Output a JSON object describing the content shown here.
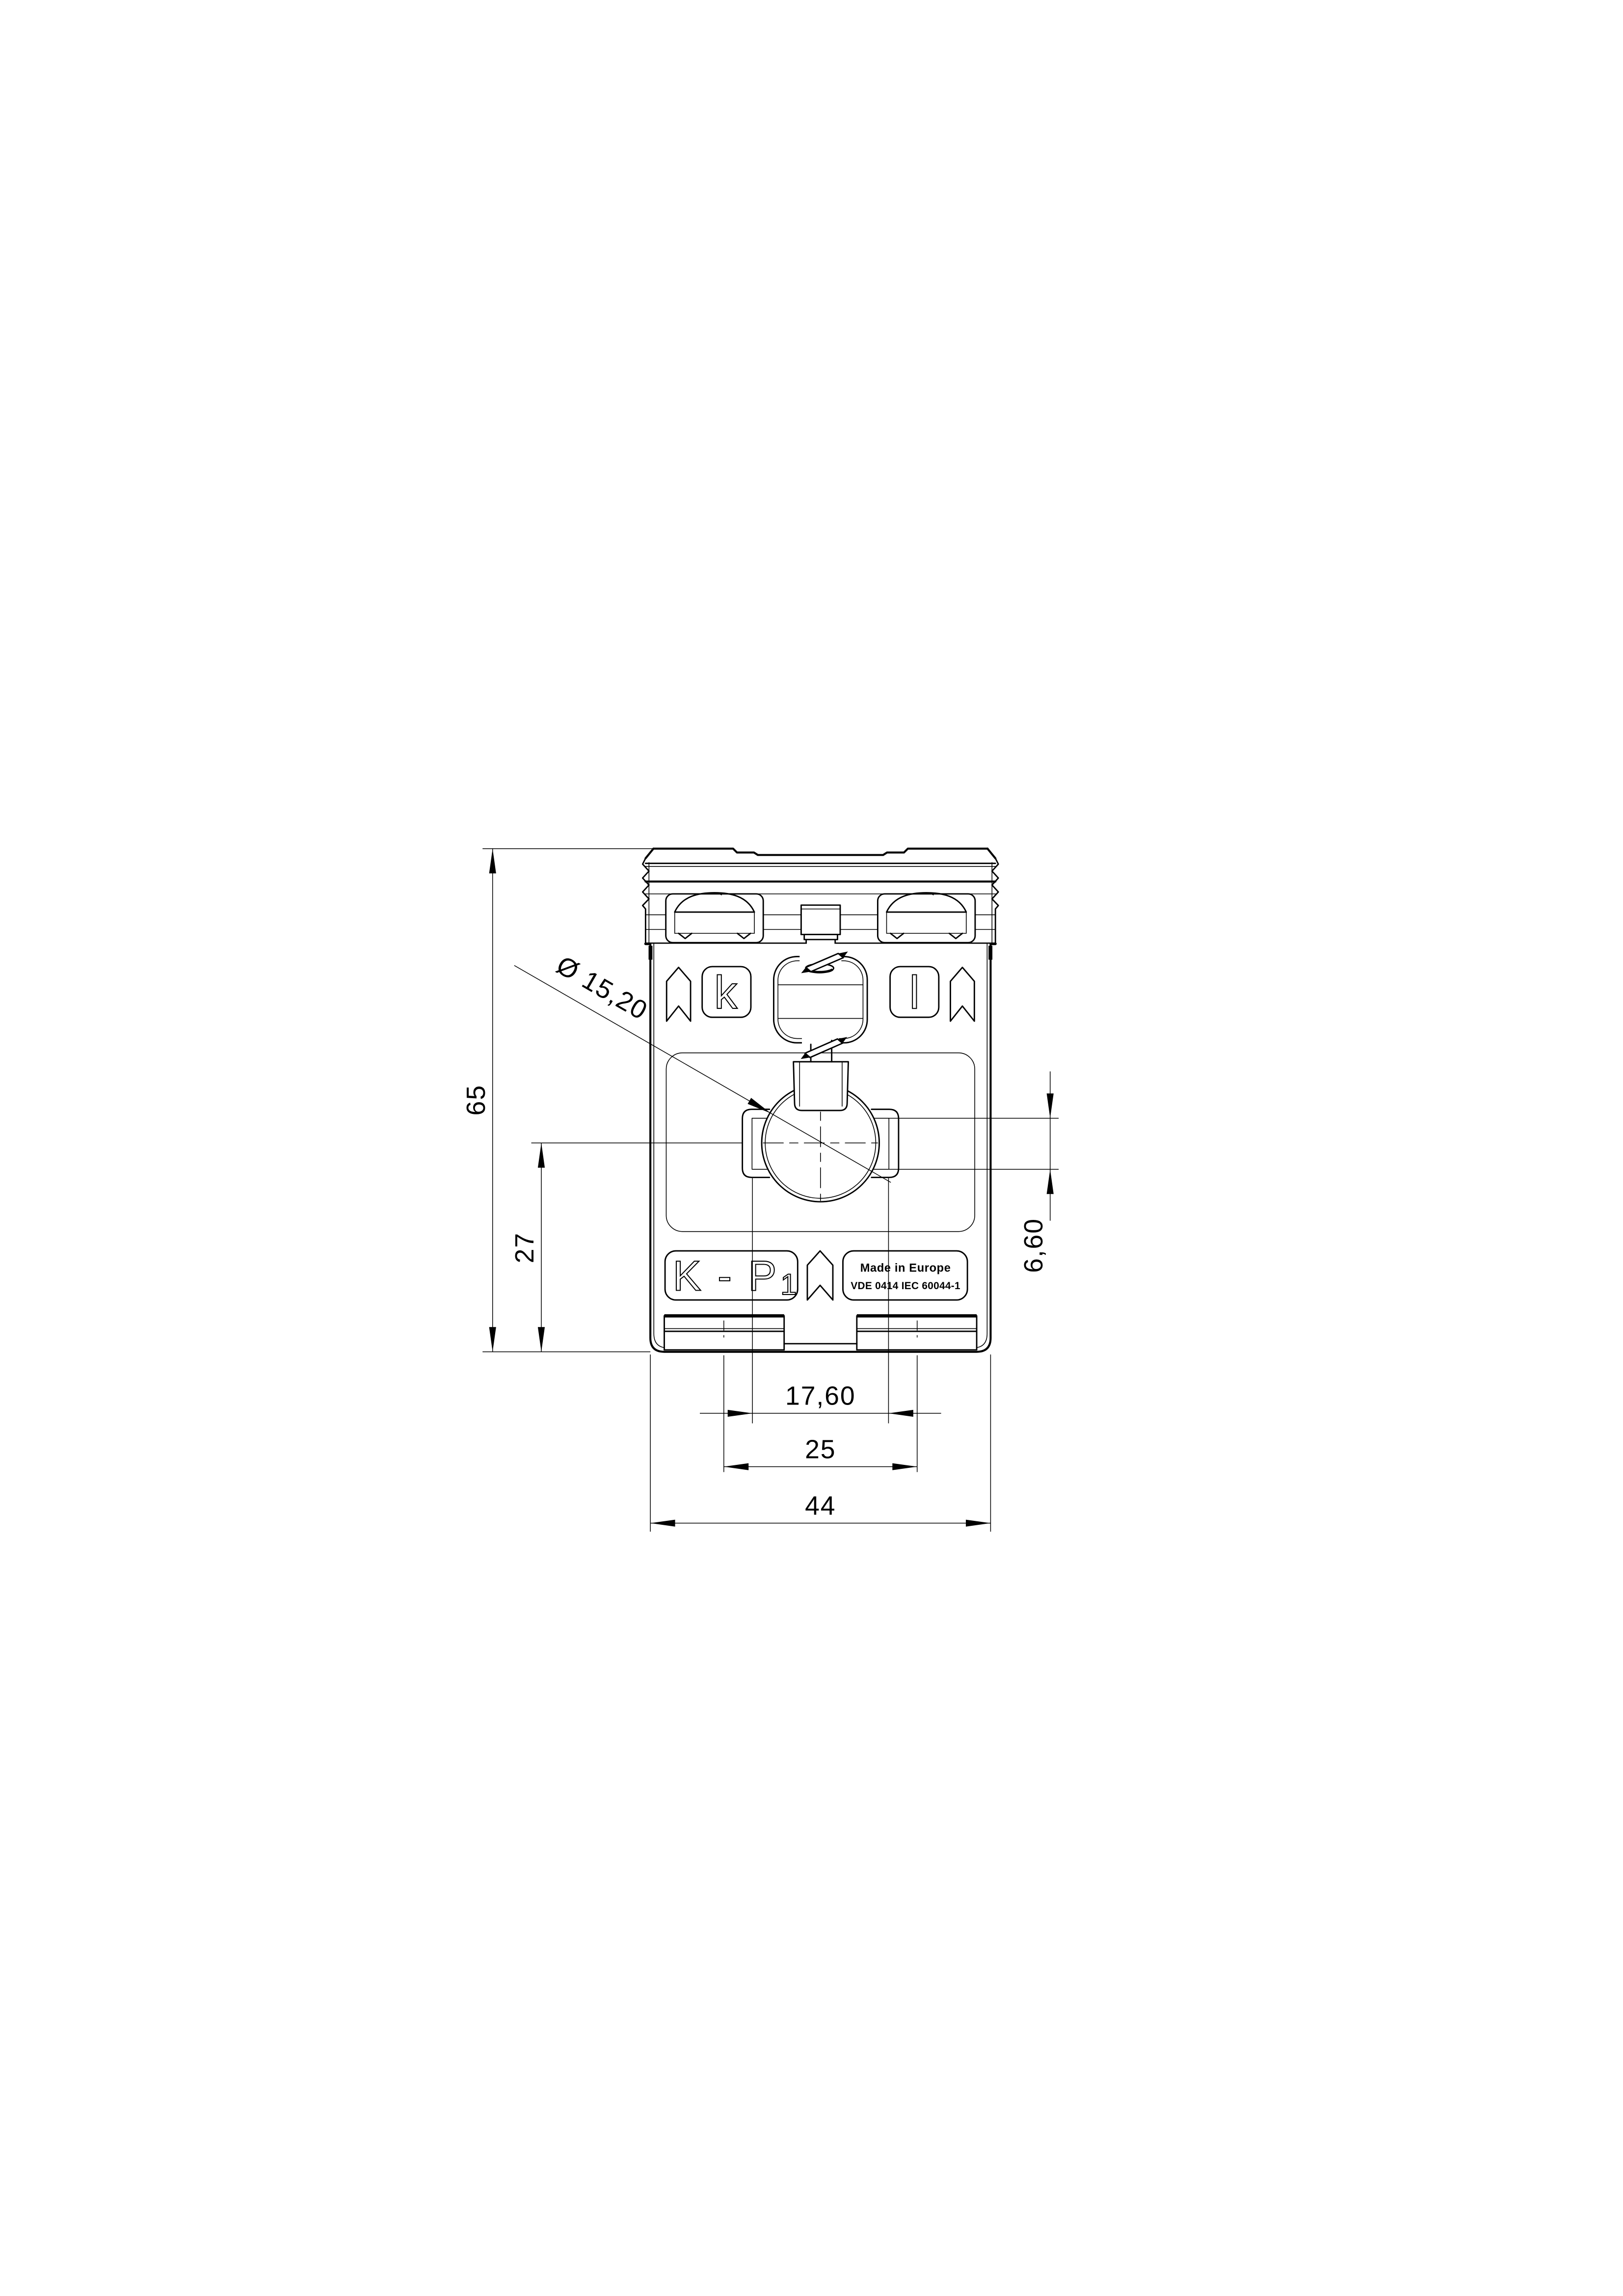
{
  "page": {
    "background": "#ffffff",
    "line_color": "#000000"
  },
  "drawing": {
    "dimensions": {
      "overall_width": "44",
      "overall_height": "65",
      "mounting_slot_spacing": "25",
      "bracket_spacing": "17,60",
      "bore_center_from_bottom": "27",
      "bore_diameter": "Ø 15,20",
      "bracket_slot_height": "6,60"
    },
    "markings": {
      "terminal_left": "k",
      "terminal_right": "l",
      "winding_label_main": "K - P",
      "winding_label_sub": "1",
      "origin_label": "Made in Europe",
      "standard_label": "VDE 0414 IEC 60044-1"
    }
  }
}
